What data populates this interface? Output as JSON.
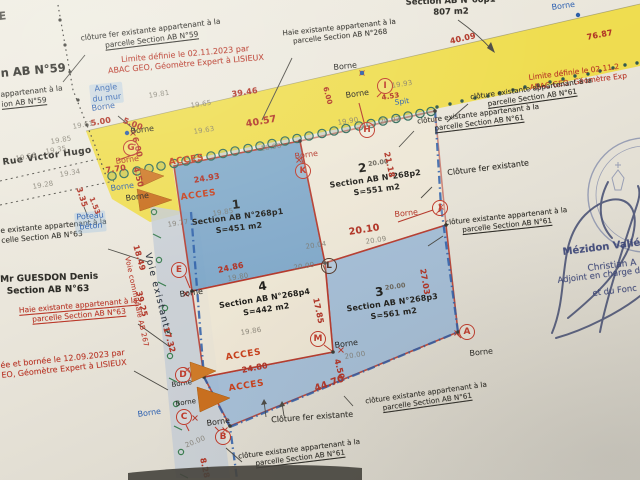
{
  "palette": {
    "paper": "#e9e4d9",
    "road_yellow": "#efdc45",
    "road_gray": "#c6cdd5",
    "parcel_blue": "#7ba6c9",
    "parcel_blue_light": "#9fbbd7",
    "boundary_blue": "#2c5ea9",
    "survey_red": "#b5392c",
    "hedge_green": "#2e6b5a",
    "ink_blue": "#2b5fb0",
    "stamp_navy": "#3c4679"
  },
  "parcels": [
    {
      "num": "1",
      "sup": "",
      "section": "Section AB N°268p1",
      "area": "S=451 m2"
    },
    {
      "num": "2",
      "sup": "20.00",
      "section": "Section AB N°268p2",
      "area": "S=551 m2"
    },
    {
      "num": "3",
      "sup": "20.00",
      "section": "Section AB N°268p3",
      "area": "S=561 m2"
    },
    {
      "num": "4",
      "sup": "",
      "section": "Section AB N°268p4",
      "area": "S=442 m2"
    }
  ],
  "markers": {
    "g": "G",
    "i": "I",
    "h": "H",
    "k": "K",
    "j": "J",
    "l": "L",
    "e": "E",
    "a": "A",
    "m": "M",
    "d": "D",
    "c": "C",
    "b": "B"
  },
  "notes": {
    "corner_frag": "E",
    "borne": "Borne",
    "acces": "ACCES",
    "spit": "Spit",
    "rue": "Rue Victor Hugo",
    "angle_mur": {
      "line1": "Angle",
      "line2": "du mur"
    },
    "poteau": {
      "line1": "Poteau",
      "line2": "béton"
    },
    "voie_existante": "Voie existante",
    "voie_communale": "Voie communale AB 267",
    "cl59": {
      "line1": "clôture fer existante appartenant à la",
      "line2": "parcelle Section AB N°59"
    },
    "n59_big": "n AB N°59",
    "n59_part": {
      "line1": "appartenant à la",
      "line2": "ion AB N°59"
    },
    "limite59": {
      "line1": "Limite définie le 02.11.2023 par",
      "line2": "ABAC GEO, Géomètre Expert à LISIEUX"
    },
    "haie268": {
      "line1": "Haie existante appartenant à la",
      "line2": "parcelle Section AB N°268"
    },
    "s60p1": {
      "line1": "Section AB N°60p1",
      "line2": "807 m2"
    },
    "limite61": {
      "line1": "Limite définie le 02.11.2",
      "line2": "ABAC GEO, Géomètre Exp"
    },
    "cl61": {
      "line1": "clôture existante appartenant à la",
      "line2": "parcelle Section AB N°61"
    },
    "clfer": "Clôture fer existante",
    "guesdon": {
      "line1": "Mr GUESDON Denis",
      "line2": "Section AB N°63"
    },
    "haie63": {
      "line1": "Haie existante appartenant à la",
      "line2": "parcelle Section AB N°63"
    },
    "cl63_part": {
      "line1": "e existante appartenant à la",
      "line2": "celle Section AB N°63"
    },
    "bornee63": {
      "line1": "ée et bornée  le 12.09.2023 par",
      "line2": "EO, Géomètre Expert à LISIEUX"
    },
    "stamp": {
      "line1": "Mézidon Vallé",
      "line2": "Christian A",
      "line3": "Adjoint en charge de",
      "line4": "et du Fonc"
    }
  },
  "meas_red": [
    "40.09",
    "76.87",
    "39.46",
    "40.57",
    "4.53",
    "6.00",
    "21.18",
    "24.93",
    "5.00",
    "5.00",
    "6.00",
    "7.70",
    "4.50",
    "3.35",
    "1.53",
    "18.49",
    "39.25",
    "17.32",
    "20.10",
    "27.03",
    "17.85",
    "24.86",
    "24.80",
    "4.50",
    "44.70",
    "8.28"
  ],
  "meas_faint": [
    "19.81",
    "19.65",
    "19.63",
    "19.85",
    "19.35",
    "19.34",
    "19.28",
    "19.56",
    "19.61",
    "19.93",
    "19.90",
    "20.02",
    "18.90",
    "19.85",
    "19.77",
    "19.80",
    "19.86",
    "20.04",
    "20.09",
    "20.00",
    "20.00",
    "20.00"
  ]
}
